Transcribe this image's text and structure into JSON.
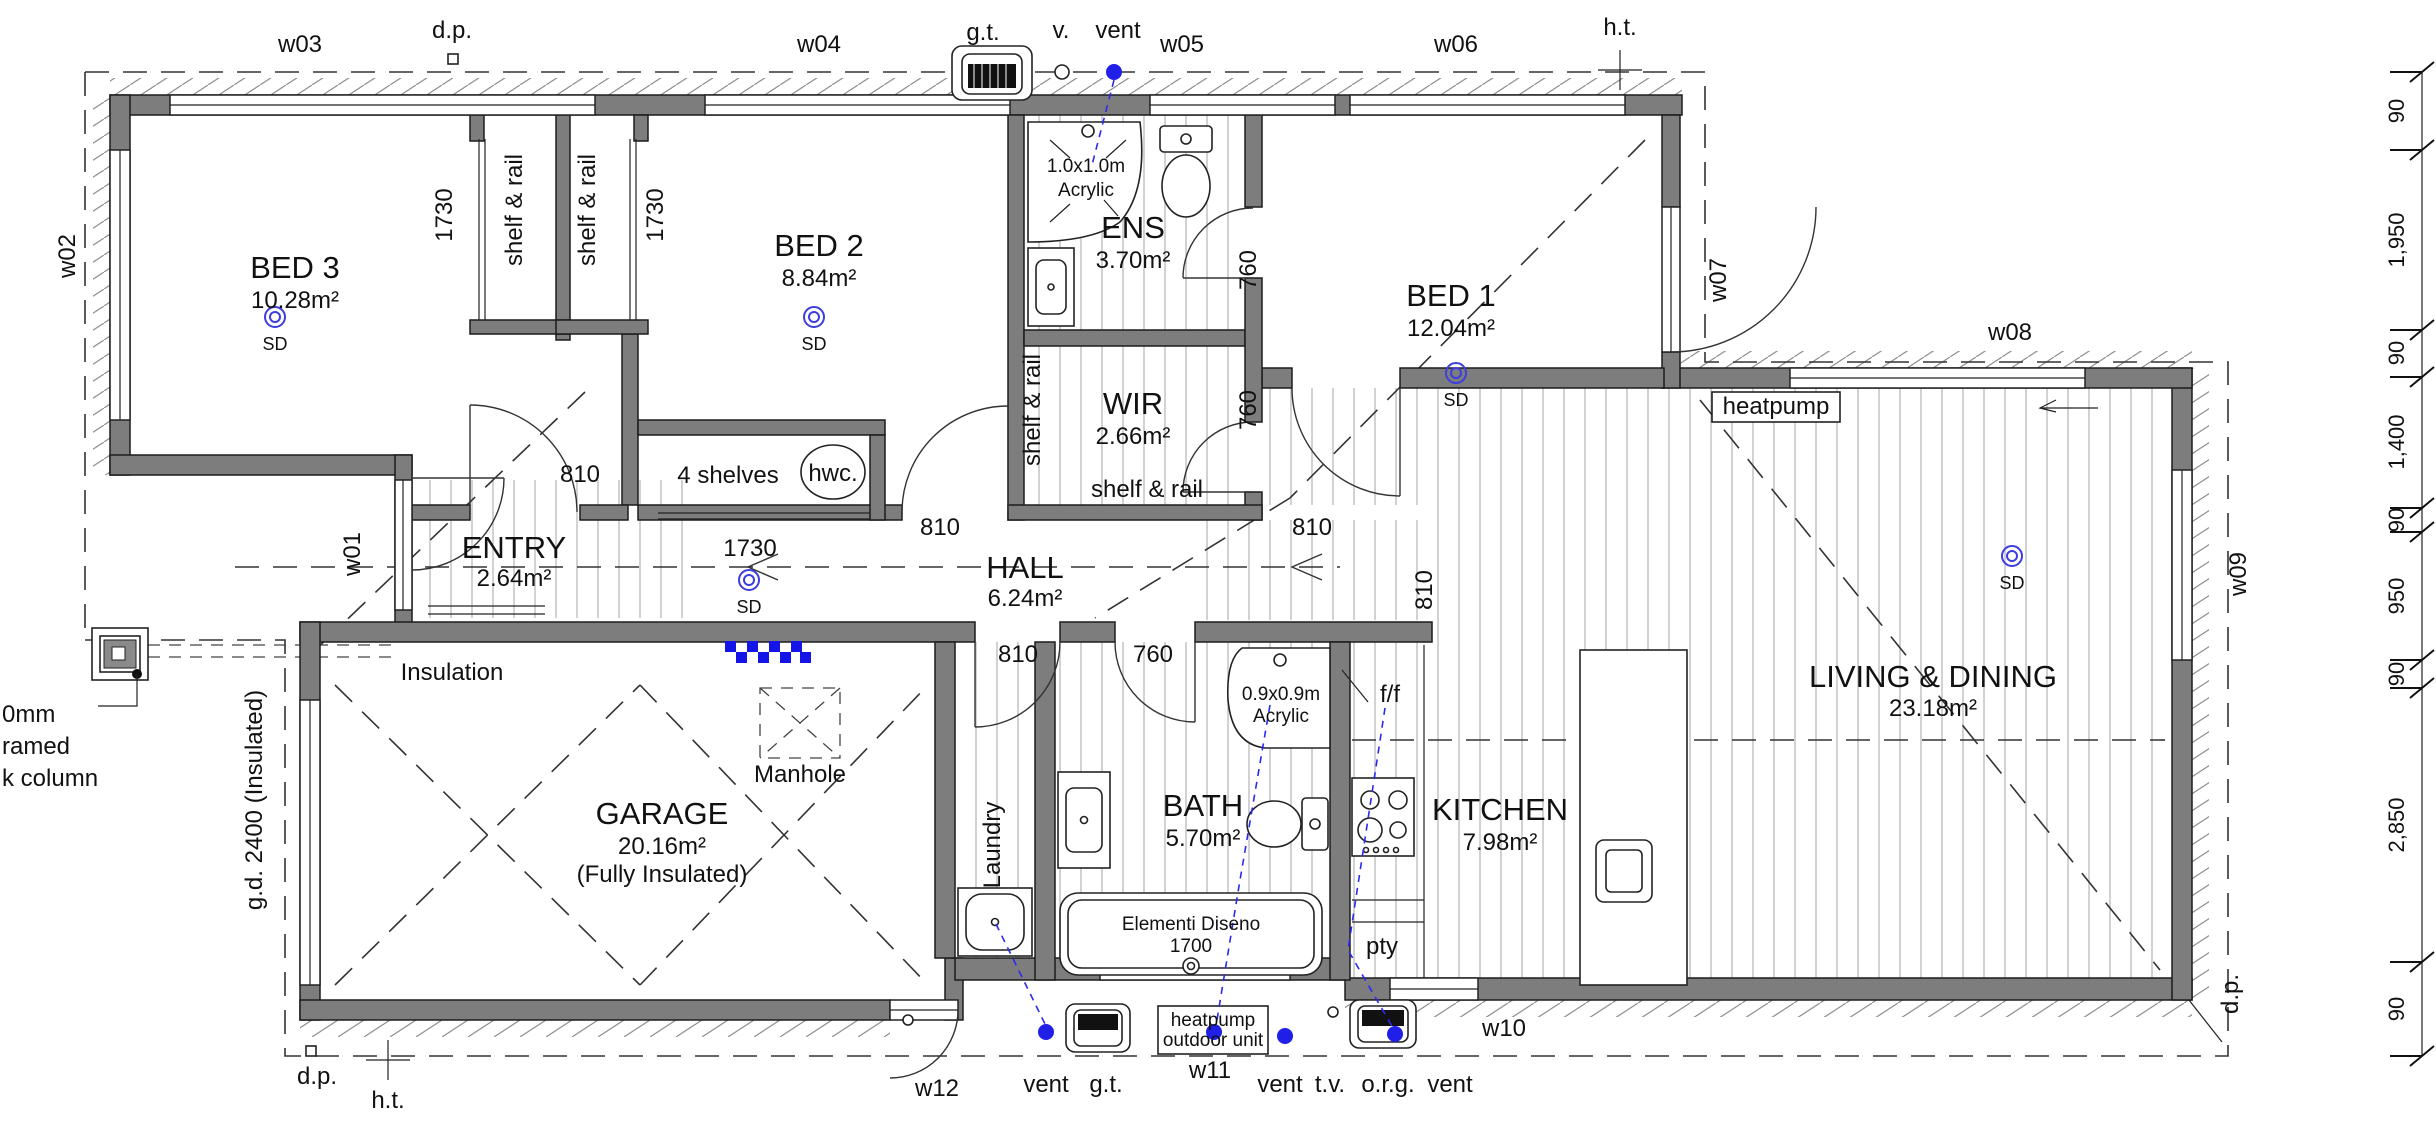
{
  "plan": {
    "rooms": {
      "bed3": {
        "name": "BED 3",
        "area": "10.28m²"
      },
      "bed2": {
        "name": "BED 2",
        "area": "8.84m²"
      },
      "ens": {
        "name": "ENS",
        "area": "3.70m²"
      },
      "bed1": {
        "name": "BED 1",
        "area": "12.04m²"
      },
      "wir": {
        "name": "WIR",
        "area": "2.66m²"
      },
      "hall": {
        "name": "HALL",
        "area": "6.24m²"
      },
      "entry": {
        "name": "ENTRY",
        "area": "2.64m²"
      },
      "garage": {
        "name": "GARAGE",
        "area": "20.16m²",
        "note": "(Fully Insulated)"
      },
      "laundry": {
        "name": "Laundry"
      },
      "bath": {
        "name": "BATH",
        "area": "5.70m²"
      },
      "kitchen": {
        "name": "KITCHEN",
        "area": "7.98m²"
      },
      "living": {
        "name": "LIVING & DINING",
        "area": "23.18m²"
      }
    },
    "windows": {
      "w01": "w01",
      "w02": "w02",
      "w03": "w03",
      "w04": "w04",
      "w05": "w05",
      "w06": "w06",
      "w07": "w07",
      "w08": "w08",
      "w09": "w09",
      "w10": "w10",
      "w11": "w11",
      "w12": "w12"
    },
    "dims": {
      "d90": "90",
      "d1950": "1,950",
      "d1400": "1,400",
      "d950": "950",
      "d2850": "2,850",
      "d810": "810",
      "d760": "760",
      "d1730": "1730"
    },
    "ann": {
      "dp": "d.p.",
      "ht": "h.t.",
      "gt": "g.t.",
      "v": "v.",
      "vent": "vent",
      "tv": "t.v.",
      "org": "o.r.g.",
      "sd": "SD",
      "shelf_rail": "shelf & rail",
      "four_shelves": "4 shelves",
      "hwc": "hwc.",
      "manhole": "Manhole",
      "insulation": "Insulation",
      "heatpump": "heatpump",
      "ff": "f/f",
      "pty": "pty",
      "gd": "g.d. 2400 (Insulated)",
      "ens_shower_size": "1.0x1.0m",
      "bath_shower_size": "0.9x0.9m",
      "acrylic": "Acrylic",
      "tub_brand": "Elementi Diseno",
      "tub_size": "1700",
      "hp_unit_1": "heatpump",
      "hp_unit_2": "outdoor unit",
      "col_1": "0mm",
      "col_2": "ramed",
      "col_3": "k column"
    }
  }
}
